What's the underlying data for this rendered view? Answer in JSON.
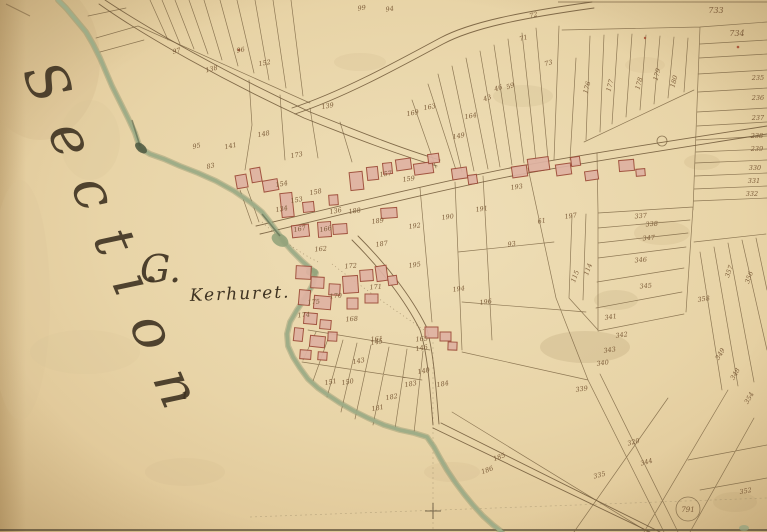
{
  "map": {
    "figure_type": "historical cadastral map",
    "section_script": "Section",
    "section_letter": "G.",
    "place_name": "Kerhuret.",
    "lone_mark": "1",
    "circled_number": "791",
    "colors": {
      "paper": "#e8d4a7",
      "paper_light": "#efdfb8",
      "paper_dark": "#d3b483",
      "ink": "#6f583a",
      "number_ink": "#7d5d3a",
      "script_ink": "#3f3322",
      "building_fill": "#dfb2a2",
      "building_stroke": "#9c4a38",
      "stream_green": "#9dac87",
      "stream_dark": "#4c5740",
      "red_dot": "#a3452c"
    },
    "parcel_numbers": [
      {
        "t": "97",
        "x": 177,
        "y": 53,
        "r": -14
      },
      {
        "t": "138",
        "x": 212,
        "y": 71,
        "r": -14
      },
      {
        "t": "96",
        "x": 241,
        "y": 52,
        "r": -10
      },
      {
        "t": "152",
        "x": 265,
        "y": 65,
        "r": -10
      },
      {
        "t": "95",
        "x": 197,
        "y": 148,
        "r": -12
      },
      {
        "t": "141",
        "x": 231,
        "y": 148,
        "r": -12
      },
      {
        "t": "83",
        "x": 211,
        "y": 168,
        "r": -12
      },
      {
        "t": "99",
        "x": 362,
        "y": 10,
        "r": -8
      },
      {
        "t": "94",
        "x": 390,
        "y": 11,
        "r": -8
      },
      {
        "t": "139",
        "x": 328,
        "y": 108,
        "r": -10
      },
      {
        "t": "148",
        "x": 264,
        "y": 136,
        "r": -10
      },
      {
        "t": "149",
        "x": 459,
        "y": 138,
        "r": -10
      },
      {
        "t": "163",
        "x": 430,
        "y": 109,
        "r": -10
      },
      {
        "t": "169",
        "x": 413,
        "y": 115,
        "r": -10
      },
      {
        "t": "164",
        "x": 471,
        "y": 118,
        "r": -10
      },
      {
        "t": "43",
        "x": 488,
        "y": 100,
        "r": -20
      },
      {
        "t": "46",
        "x": 499,
        "y": 90,
        "r": -20
      },
      {
        "t": "59",
        "x": 511,
        "y": 88,
        "r": -20
      },
      {
        "t": "73",
        "x": 549,
        "y": 65,
        "r": -15
      },
      {
        "t": "72",
        "x": 534,
        "y": 17,
        "r": -15
      },
      {
        "t": "71",
        "x": 524,
        "y": 40,
        "r": -15
      },
      {
        "t": "176",
        "x": 589,
        "y": 88,
        "r": -75
      },
      {
        "t": "177",
        "x": 612,
        "y": 86,
        "r": -75
      },
      {
        "t": "178",
        "x": 641,
        "y": 84,
        "r": -75
      },
      {
        "t": "179",
        "x": 659,
        "y": 75,
        "r": -75
      },
      {
        "t": "180",
        "x": 676,
        "y": 82,
        "r": -75
      },
      {
        "t": "733",
        "x": 716,
        "y": 13,
        "r": 0,
        "s": 8
      },
      {
        "t": "734",
        "x": 737,
        "y": 36,
        "r": 0,
        "s": 8
      },
      {
        "t": "235",
        "x": 758,
        "y": 80,
        "r": 0
      },
      {
        "t": "236",
        "x": 758,
        "y": 100,
        "r": 0
      },
      {
        "t": "237",
        "x": 758,
        "y": 120,
        "r": 0
      },
      {
        "t": "238",
        "x": 757,
        "y": 138,
        "r": 0
      },
      {
        "t": "239",
        "x": 757,
        "y": 151,
        "r": 0
      },
      {
        "t": "330",
        "x": 755,
        "y": 170,
        "r": 0
      },
      {
        "t": "331",
        "x": 754,
        "y": 183,
        "r": 0
      },
      {
        "t": "332",
        "x": 752,
        "y": 196,
        "r": 0
      },
      {
        "t": "337",
        "x": 641,
        "y": 218,
        "r": -5
      },
      {
        "t": "338",
        "x": 652,
        "y": 226,
        "r": -5
      },
      {
        "t": "347",
        "x": 649,
        "y": 240,
        "r": -5
      },
      {
        "t": "346",
        "x": 641,
        "y": 262,
        "r": -5
      },
      {
        "t": "345",
        "x": 646,
        "y": 288,
        "r": -5
      },
      {
        "t": "358",
        "x": 704,
        "y": 301,
        "r": -8
      },
      {
        "t": "114",
        "x": 590,
        "y": 270,
        "r": -70
      },
      {
        "t": "115",
        "x": 577,
        "y": 277,
        "r": -70
      },
      {
        "t": "357",
        "x": 731,
        "y": 272,
        "r": -70
      },
      {
        "t": "356",
        "x": 751,
        "y": 278,
        "r": -70
      },
      {
        "t": "341",
        "x": 611,
        "y": 319,
        "r": -8
      },
      {
        "t": "342",
        "x": 622,
        "y": 337,
        "r": -8
      },
      {
        "t": "343",
        "x": 610,
        "y": 352,
        "r": -8
      },
      {
        "t": "340",
        "x": 603,
        "y": 365,
        "r": -8
      },
      {
        "t": "339",
        "x": 582,
        "y": 391,
        "r": -8
      },
      {
        "t": "335",
        "x": 600,
        "y": 477,
        "r": -15
      },
      {
        "t": "320",
        "x": 634,
        "y": 444,
        "r": -15
      },
      {
        "t": "344",
        "x": 647,
        "y": 464,
        "r": -15
      },
      {
        "t": "354",
        "x": 751,
        "y": 399,
        "r": -60
      },
      {
        "t": "349",
        "x": 722,
        "y": 355,
        "r": -60
      },
      {
        "t": "348",
        "x": 737,
        "y": 375,
        "r": -60
      },
      {
        "t": "352",
        "x": 746,
        "y": 493,
        "r": -10
      },
      {
        "t": "151",
        "x": 331,
        "y": 384,
        "r": -10
      },
      {
        "t": "150",
        "x": 348,
        "y": 384,
        "r": -10
      },
      {
        "t": "143",
        "x": 359,
        "y": 363,
        "r": -10
      },
      {
        "t": "140",
        "x": 424,
        "y": 373,
        "r": -10
      },
      {
        "t": "183",
        "x": 411,
        "y": 386,
        "r": -10
      },
      {
        "t": "182",
        "x": 392,
        "y": 399,
        "r": -10
      },
      {
        "t": "181",
        "x": 378,
        "y": 410,
        "r": -10
      },
      {
        "t": "145",
        "x": 377,
        "y": 344,
        "r": -10
      },
      {
        "t": "146",
        "x": 422,
        "y": 350,
        "r": -10
      },
      {
        "t": "184",
        "x": 443,
        "y": 386,
        "r": -10
      },
      {
        "t": "185",
        "x": 500,
        "y": 459,
        "r": -20
      },
      {
        "t": "186",
        "x": 488,
        "y": 472,
        "r": -20
      },
      {
        "t": "173",
        "x": 297,
        "y": 157,
        "r": -10
      },
      {
        "t": "154",
        "x": 282,
        "y": 186,
        "r": -10
      },
      {
        "t": "158",
        "x": 316,
        "y": 194,
        "r": -10
      },
      {
        "t": "153",
        "x": 297,
        "y": 202,
        "r": -10
      },
      {
        "t": "134",
        "x": 282,
        "y": 211,
        "r": -10
      },
      {
        "t": "136",
        "x": 336,
        "y": 213,
        "r": -10
      },
      {
        "t": "166",
        "x": 326,
        "y": 231,
        "r": -10
      },
      {
        "t": "167",
        "x": 300,
        "y": 231,
        "r": -10
      },
      {
        "t": "188",
        "x": 355,
        "y": 213,
        "r": -8
      },
      {
        "t": "189",
        "x": 378,
        "y": 223,
        "r": -8
      },
      {
        "t": "187",
        "x": 382,
        "y": 246,
        "r": -8
      },
      {
        "t": "192",
        "x": 415,
        "y": 228,
        "r": -8
      },
      {
        "t": "190",
        "x": 448,
        "y": 219,
        "r": -8
      },
      {
        "t": "193",
        "x": 517,
        "y": 189,
        "r": -8
      },
      {
        "t": "191",
        "x": 482,
        "y": 211,
        "r": -8
      },
      {
        "t": "61",
        "x": 542,
        "y": 223,
        "r": -8
      },
      {
        "t": "93",
        "x": 512,
        "y": 246,
        "r": -8
      },
      {
        "t": "197",
        "x": 571,
        "y": 218,
        "r": -8
      },
      {
        "t": "195",
        "x": 415,
        "y": 267,
        "r": -8
      },
      {
        "t": "196",
        "x": 486,
        "y": 304,
        "r": -8
      },
      {
        "t": "194",
        "x": 459,
        "y": 291,
        "r": -8
      },
      {
        "t": "162",
        "x": 321,
        "y": 251,
        "r": -5
      },
      {
        "t": "172",
        "x": 351,
        "y": 268,
        "r": -5
      },
      {
        "t": "171",
        "x": 376,
        "y": 289,
        "r": -5
      },
      {
        "t": "170",
        "x": 336,
        "y": 298,
        "r": -5
      },
      {
        "t": "175",
        "x": 314,
        "y": 304,
        "r": -5
      },
      {
        "t": "174",
        "x": 304,
        "y": 317,
        "r": -5
      },
      {
        "t": "168",
        "x": 352,
        "y": 321,
        "r": -5
      },
      {
        "t": "165",
        "x": 422,
        "y": 341,
        "r": -5
      },
      {
        "t": "161",
        "x": 377,
        "y": 341,
        "r": -5
      },
      {
        "t": "157",
        "x": 386,
        "y": 176,
        "r": -8
      },
      {
        "t": "159",
        "x": 409,
        "y": 181,
        "r": -8
      }
    ]
  }
}
